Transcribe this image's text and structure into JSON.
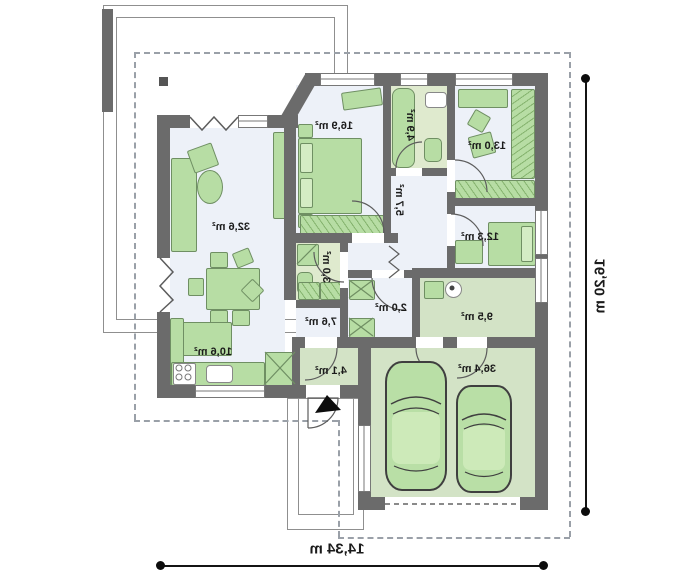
{
  "plan": {
    "title": "single-storey house floor plan (mirrored print)",
    "rooms": [
      {
        "id": "living-room",
        "area": "32,6 m²"
      },
      {
        "id": "bedroom-1",
        "area": "16,9 m²"
      },
      {
        "id": "bathroom",
        "area": "4,9 m²"
      },
      {
        "id": "bedroom-2",
        "area": "13,0 m²"
      },
      {
        "id": "corridor",
        "area": "5,7 m²"
      },
      {
        "id": "bedroom-3",
        "area": "12,3 m²"
      },
      {
        "id": "wc",
        "area": "3,0 m²"
      },
      {
        "id": "closet",
        "area": "2,0 m²"
      },
      {
        "id": "hallway",
        "area": "7,6 m²"
      },
      {
        "id": "utility-room",
        "area": "9,5 m²"
      },
      {
        "id": "kitchen",
        "area": "10,6 m²"
      },
      {
        "id": "entry",
        "area": "4,1 m²"
      },
      {
        "id": "garage",
        "area": "36,4 m²"
      }
    ],
    "dimensions": {
      "width": "14,34 m",
      "height": "16,20 m"
    },
    "colors": {
      "wall": "#6b6b6b",
      "room_floor": "#edf1f8",
      "green_floor": "#d3e3c6",
      "furniture": "#b7dda4",
      "roof_dash": "#9aa0a8",
      "dimension": "#141414"
    }
  }
}
